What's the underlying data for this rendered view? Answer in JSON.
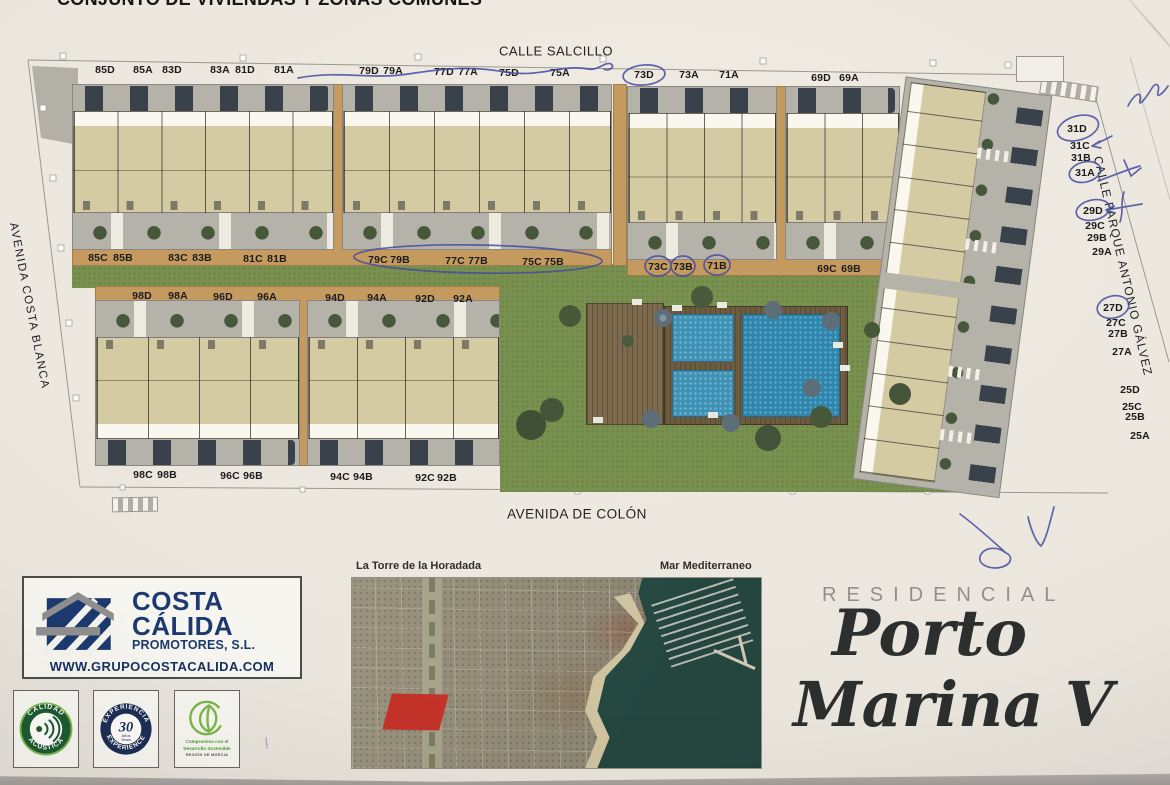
{
  "title": "CONJUNTO DE VIVIENDAS Y ZONAS COMUNES",
  "streets": {
    "top": "CALLE SALCILLO",
    "bottom": "AVENIDA DE COLÓN",
    "left": "AVENIDA COSTA BLANCA",
    "right": "CALLE PARQUE ANTONIO GÁLVEZ"
  },
  "units": {
    "row_top": [
      "85D",
      "85A",
      "83D",
      "83A",
      "81D",
      "81A",
      "79D",
      "79A",
      "77D",
      "77A",
      "75D",
      "75A",
      "73D",
      "73A",
      "71A",
      "69D",
      "69A"
    ],
    "row_mid": [
      "85C",
      "85B",
      "83C",
      "83B",
      "81C",
      "81B",
      "79C",
      "79B",
      "77C",
      "77B",
      "75C",
      "75B",
      "73C",
      "73B",
      "71B",
      "69C",
      "69B"
    ],
    "block2_top": [
      "98D",
      "98A",
      "96D",
      "96A",
      "94D",
      "94A",
      "92D",
      "92A"
    ],
    "block2_bottom": [
      "98C",
      "98B",
      "96C",
      "96B",
      "94C",
      "94B",
      "92C",
      "92B"
    ],
    "right_col": [
      "31D",
      "31C",
      "31B",
      "31A",
      "29D",
      "29C",
      "29B",
      "29A",
      "27D",
      "27C",
      "27B",
      "27A",
      "25D",
      "25C",
      "25B",
      "25A"
    ]
  },
  "annotations": {
    "pen_color": "#454CA0",
    "circled_units": [
      "73D",
      "79C-75B",
      "73C",
      "73B",
      "71B",
      "31D",
      "31A",
      "29D",
      "27D"
    ]
  },
  "logo": {
    "line1": "COSTA",
    "line2": "CÁLIDA",
    "line3": "PROMOTORES, S.L.",
    "website": "WWW.GRUPOCOSTACALIDA.COM"
  },
  "badges": {
    "acoustic": {
      "top": "CALIDAD",
      "bottom": "ACÚSTICA"
    },
    "experience": {
      "top": "EXPERIENCIA",
      "bottom": "EXPERIENCE",
      "value": "30",
      "sub1": "Años",
      "sub2": "Years"
    },
    "sustain": {
      "line1": "Compromiso con el",
      "line2": "Desarrollo Sostenible",
      "line3": "REGIÓN DE MURCIA"
    }
  },
  "map_labels": {
    "left": "La Torre de la Horadada",
    "right": "Mar Mediterraneo"
  },
  "brand": {
    "eyebrow": "RESIDENCIAL",
    "script1": "Porto",
    "script2": "Marina V"
  },
  "colors": {
    "grass": "#79914f",
    "pool_water": "#2e86ae",
    "sidewalk_tan": "#c59a5f",
    "brand_navy": "#1d3a70",
    "badge_green": "#1e5b33",
    "plot_red": "#c4332a"
  }
}
